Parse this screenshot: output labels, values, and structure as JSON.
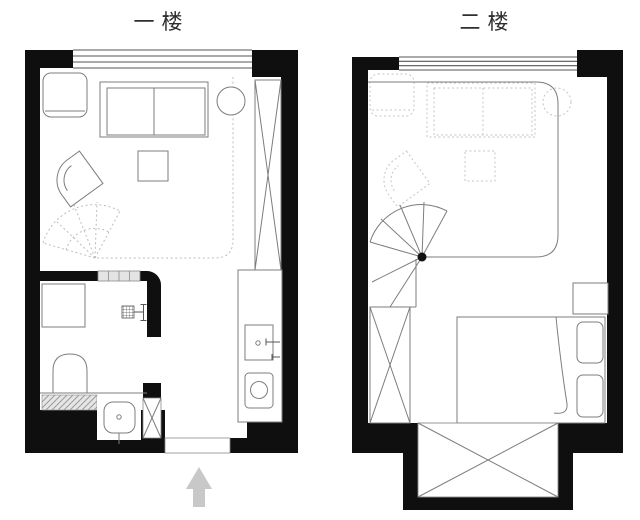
{
  "titles": {
    "floor1": "一楼",
    "floor2": "二楼"
  },
  "floors": [
    {
      "name": "first-floor",
      "label": "一楼",
      "rooms": [
        "living-room",
        "bathroom",
        "kitchen",
        "entry"
      ],
      "fixtures": [
        "window",
        "storage-cabinet",
        "sofa",
        "plant-pot",
        "coffee-table",
        "lounge-chair",
        "tall-wardrobe",
        "spiral-stair-projection",
        "void-outline-dotted",
        "shower-tray",
        "shower-head",
        "toilet",
        "bath-mat",
        "washbasin",
        "laundry-cabinet",
        "glass-partition",
        "entry-door-opening",
        "kitchen-counter",
        "kitchen-sink",
        "washing-machine",
        "entrance-arrow"
      ]
    },
    {
      "name": "second-floor",
      "label": "二楼",
      "rooms": [
        "bedroom",
        "stair-landing"
      ],
      "fixtures": [
        "window",
        "spiral-staircase",
        "stair-steps",
        "wardrobe",
        "double-bed",
        "pillow",
        "pillow",
        "blanket-fold",
        "nightstand",
        "storage-closet",
        "void-opening-railing",
        "ghost-cabinet",
        "ghost-sofa",
        "ghost-plant",
        "ghost-coffee-table",
        "ghost-lounge-chair"
      ]
    }
  ],
  "entrance_arrow": {
    "direction": "up",
    "meaning": "entrance"
  },
  "colors": {
    "background": "#ffffff",
    "wall": "#0f0f0f",
    "line": "#7d7d7d",
    "ghost": "#c5c5c5",
    "dotted": "#bdbdbd",
    "arrow": "#c8c8c8",
    "glass": "#e4e4e4"
  }
}
